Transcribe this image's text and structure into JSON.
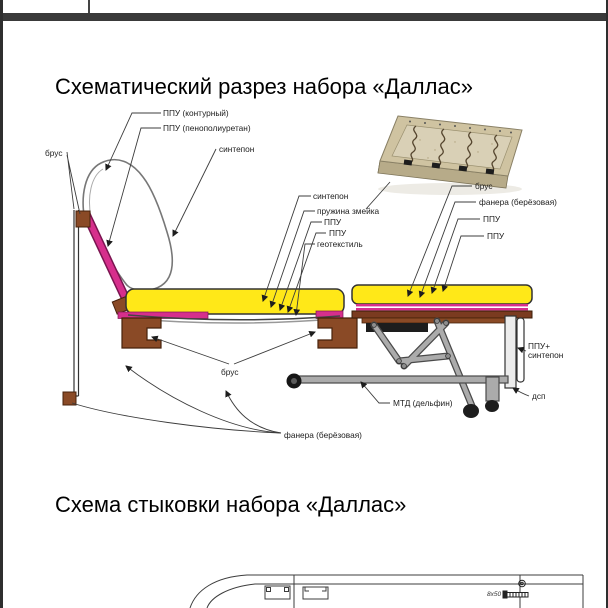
{
  "titles": {
    "cutaway": "Схематический разрез набора «Даллас»",
    "joining": "Схема стыковки набора «Даллас»"
  },
  "labels": {
    "ppu_contour": "ППУ (контурный)",
    "ppu_foam": "ППУ (пенополиуретан)",
    "sintepon_top": "синтепон",
    "brus_top_left": "брус",
    "sintepon_mid": "синтепон",
    "spring_snake": "пружина змейка",
    "ppu_mid_1": "ППУ",
    "ppu_mid_2": "ППУ",
    "geotextile": "геотекстиль",
    "brus_right": "брус",
    "fanera_right": "фанера (берёзовая)",
    "ppu_right_1": "ППУ",
    "ppu_right_2": "ППУ",
    "ppu_plus": "ППУ+",
    "sintepon_plus": "синтепон",
    "dsp": "дсп",
    "mtd": "МТД (дельфин)",
    "brus_bottom": "брус",
    "fanera_bottom": "фанера (берёзовая)",
    "screw_size": "8x50"
  },
  "colors": {
    "foam-yellow": "#FFE818",
    "magenta": "#D62F8C",
    "magenta-dark": "#7A1450",
    "wood-brown": "#8A4A26",
    "wood-dark": "#47220B",
    "plank-brown": "#7A3B20",
    "metal-gray": "#ABABAB",
    "metal-dark": "#4A4A4A",
    "frame-tan": "#CFC3A1",
    "frame-tan-light": "#D9D0B6",
    "separator": "#3A3A3A"
  }
}
